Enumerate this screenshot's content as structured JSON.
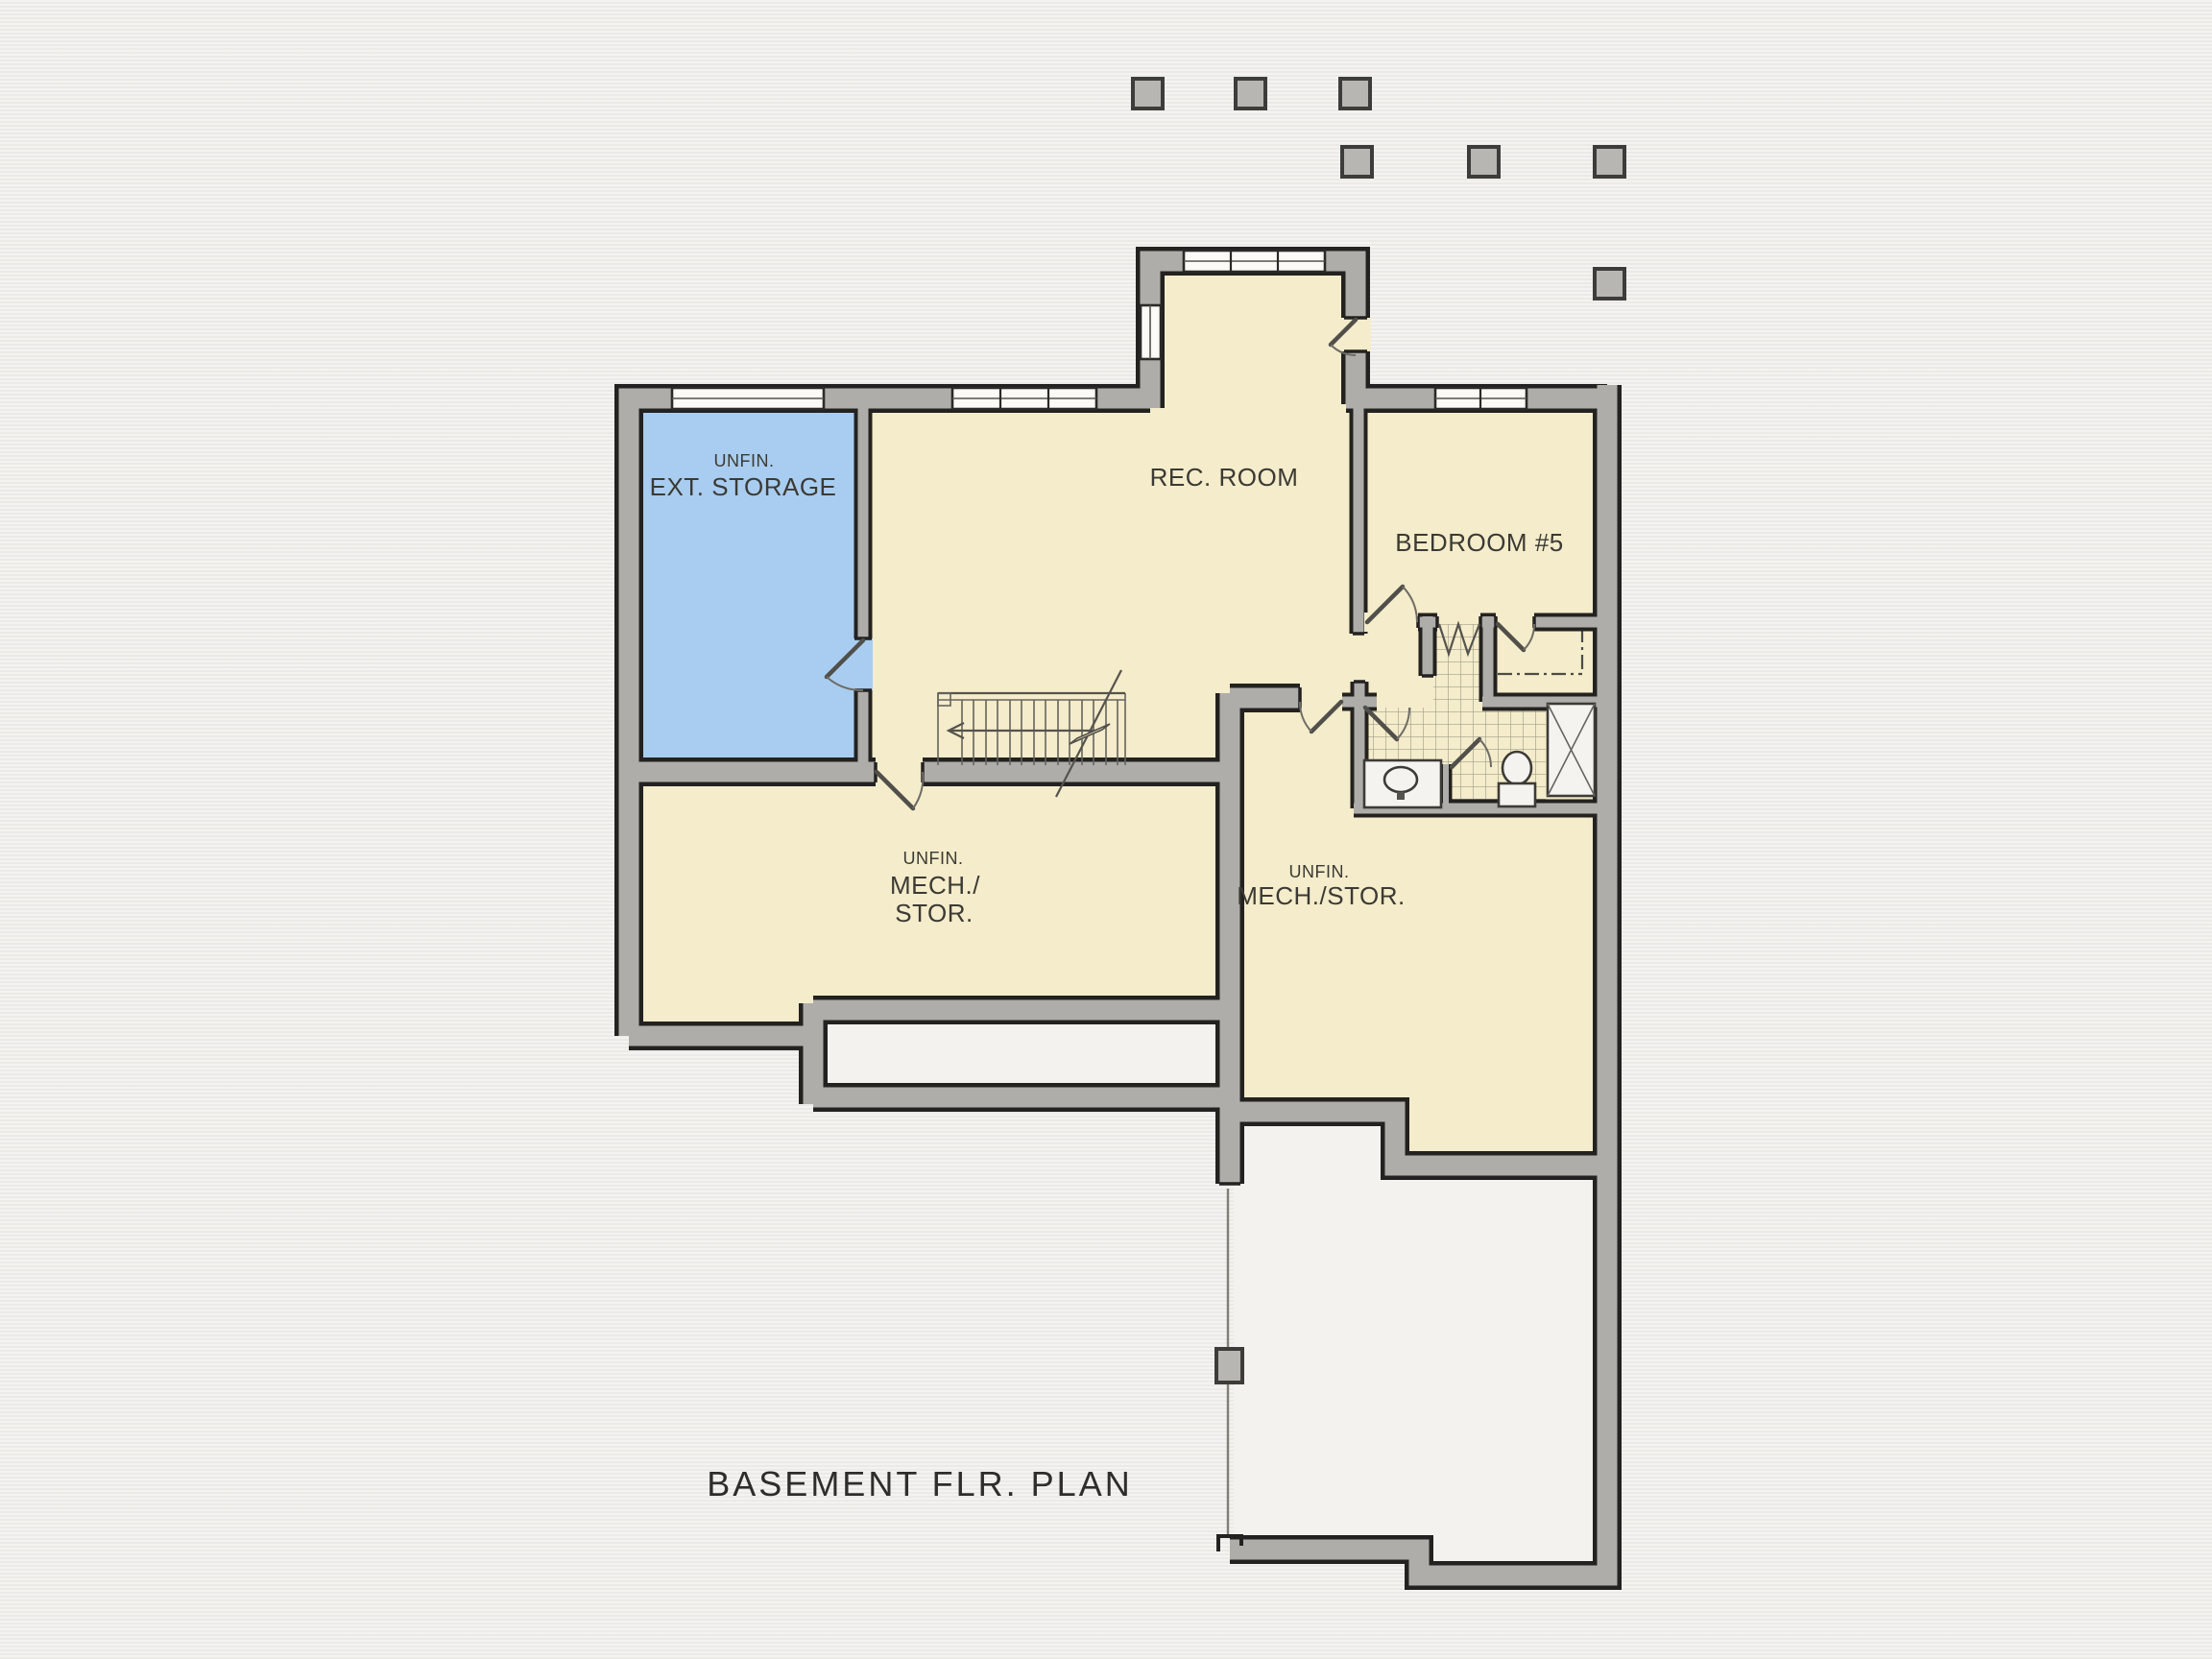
{
  "plan_title": "BASEMENT FLR. PLAN",
  "rooms": {
    "ext_storage": {
      "prefix": "UNFIN.",
      "name": "EXT. STORAGE"
    },
    "rec_room": {
      "name": "REC. ROOM"
    },
    "bedroom_5": {
      "name": "BEDROOM #5"
    },
    "mech_stor_left": {
      "prefix": "UNFIN.",
      "name_line1": "MECH./",
      "name_line2": "STOR."
    },
    "mech_stor_right": {
      "prefix": "UNFIN.",
      "name": "MECH./STOR."
    }
  },
  "colors": {
    "background": "#efedea",
    "room_fill": "#f4ecca",
    "storage_fill": "#a9cdf0",
    "unfinished_fill": "#f3f2ef",
    "wall_fill": "#aeadaa",
    "wall_outline": "#232220",
    "text": "#3b3a34"
  }
}
